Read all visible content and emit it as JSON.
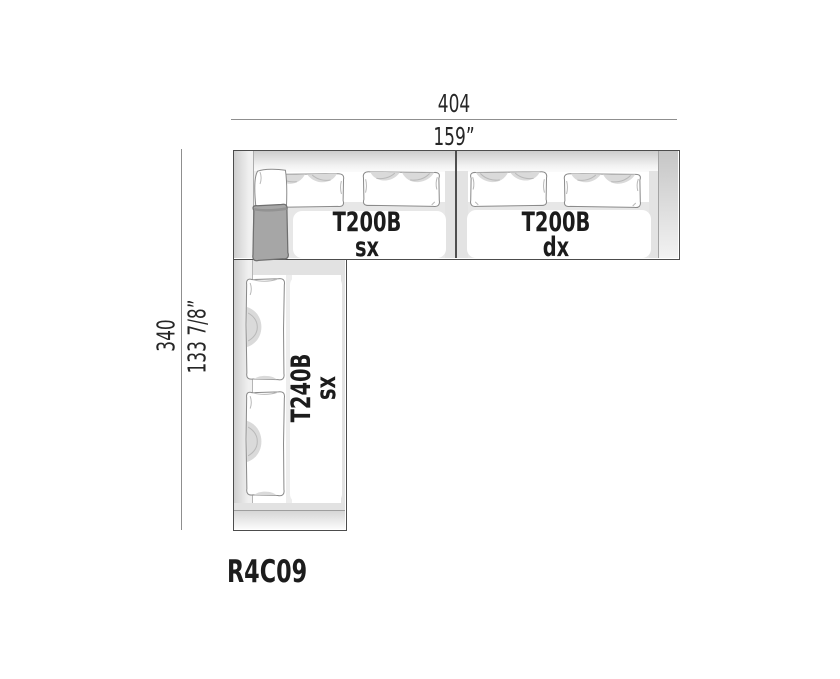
{
  "product": {
    "code": "R4C09"
  },
  "dimensions": {
    "width_cm": "404",
    "width_in": "159”",
    "depth_cm": "340",
    "depth_in": "133 7/8”"
  },
  "modules": {
    "top_left": {
      "name": "T200B",
      "variant": "sx"
    },
    "top_right": {
      "name": "T200B",
      "variant": "dx"
    },
    "side": {
      "name": "T240B",
      "variant": "sx"
    }
  },
  "colors": {
    "outline": "#4c4c4c",
    "dim_line": "#8f8f8f",
    "shading": "#dadada",
    "accent_pillow": "#a6a6a6"
  }
}
